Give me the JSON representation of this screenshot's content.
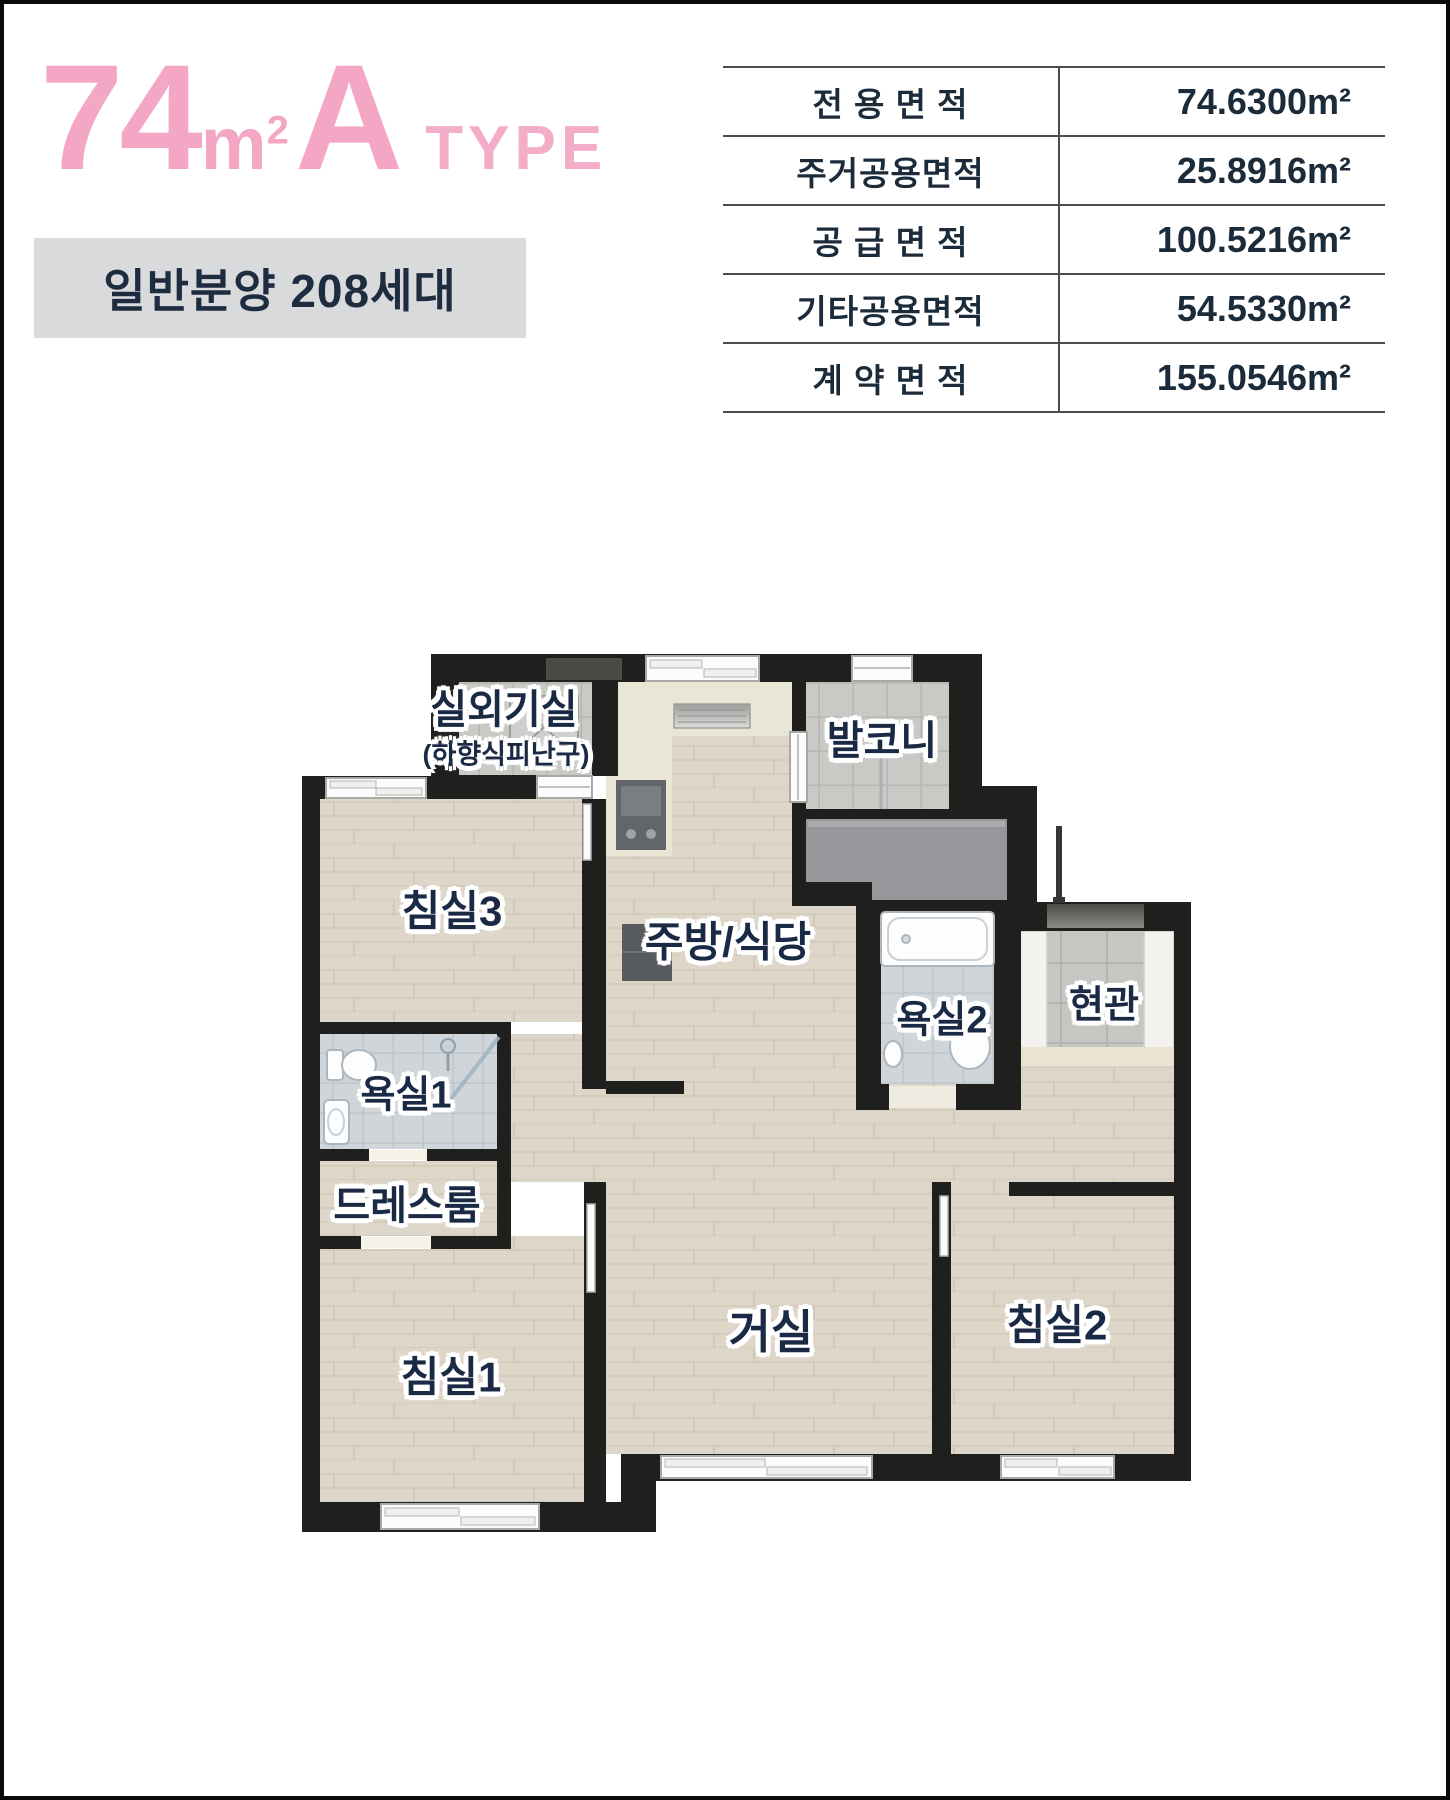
{
  "header": {
    "title": {
      "area": "74",
      "unit_base": "m",
      "unit_sup": "2",
      "type_letter": "A",
      "type_word": "TYPE"
    },
    "subtitle": "일반분양 208세대",
    "accent_pink": "#f3a7c5"
  },
  "area_table": {
    "rows": [
      {
        "label": "전 용 면 적",
        "value": "74.6300m²"
      },
      {
        "label": "주거공용면적",
        "value": "25.8916m²"
      },
      {
        "label": "공 급 면 적",
        "value": "100.5216m²"
      },
      {
        "label": "기타공용면적",
        "value": "54.5330m²"
      },
      {
        "label": "계 약 면 적",
        "value": "155.0546m²"
      }
    ]
  },
  "plan": {
    "rooms": {
      "outdoor_unit": "실외기실",
      "outdoor_unit_sub": "(하향식피난구)",
      "balcony": "발코니",
      "bed3": "침실3",
      "kitchen": "주방/식당",
      "bath2": "욕실2",
      "entrance": "현관",
      "bath1": "욕실1",
      "dressroom": "드레스룸",
      "bed1": "침실1",
      "living": "거실",
      "bed2": "침실2"
    },
    "colors": {
      "wall": "#1f1f1d",
      "wood": "#ded6c8",
      "tile": "#c9c9c6",
      "bath_tile": "#d0d5d9",
      "entry_tile": "#c6c6c3",
      "slab": "#96979a",
      "counter": "#eae6d6",
      "navy_label": "#1b2a44"
    }
  }
}
